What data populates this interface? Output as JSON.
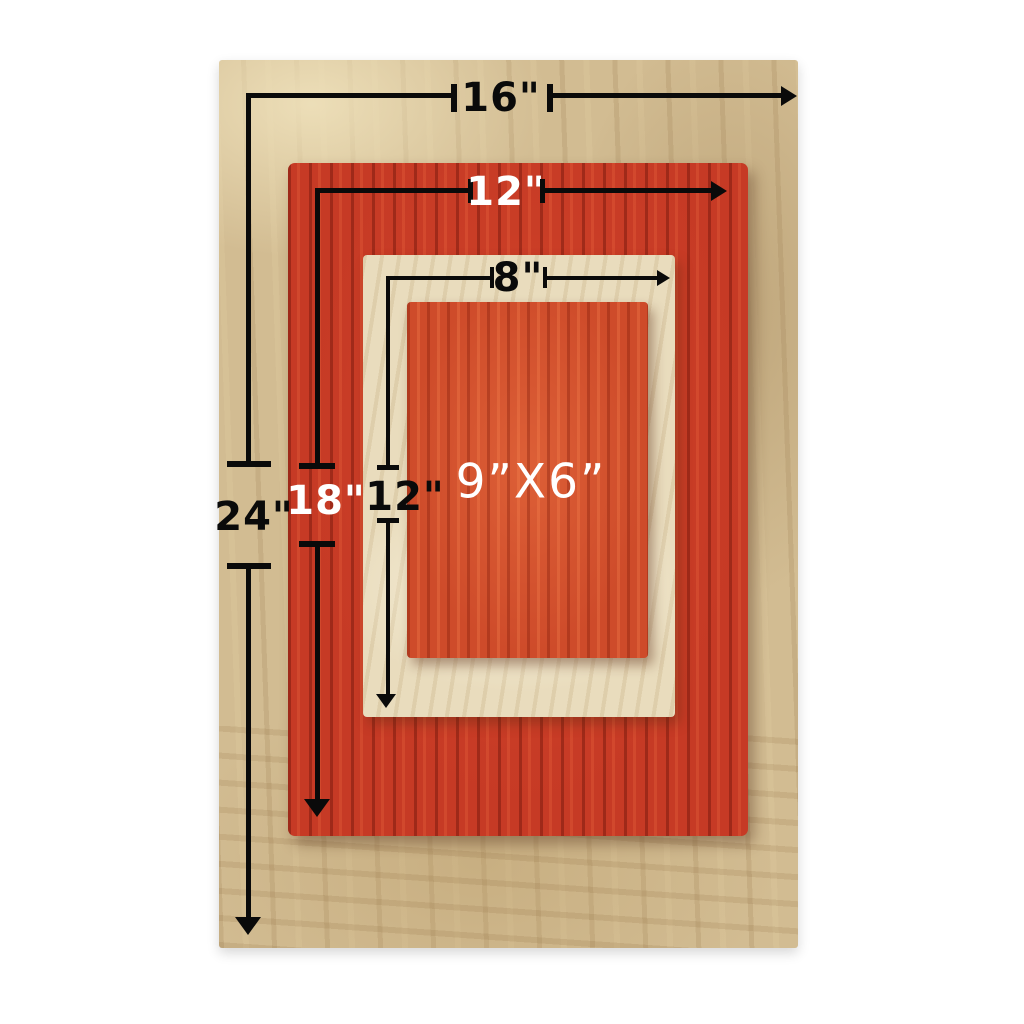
{
  "image": {
    "kind": "annotated-product-photo",
    "subject": "Four stacked rectangular wooden boards with size measurements"
  },
  "colors": {
    "page_bg": "#ffffff",
    "outer_board": "#d2bc92",
    "red_board": "#c63a25",
    "frame_board": "#e9dcbd",
    "inner_board": "#ce4b2a",
    "annotation": "#0a0a0a",
    "annotation_light": "#ffffff"
  },
  "annotations": {
    "outer_width": "16\"",
    "outer_height": "24\"",
    "red_width": "12\"",
    "red_height": "18\"",
    "frame_width": "8\"",
    "frame_height": "12\"",
    "inner_size": "9”X6”"
  }
}
